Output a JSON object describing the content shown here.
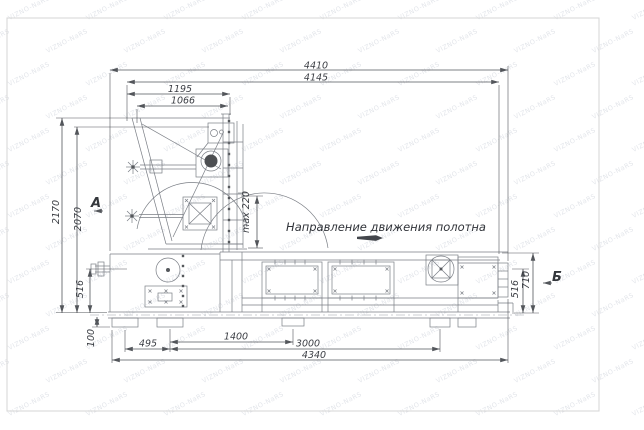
{
  "drawing": {
    "direction_note": "Направление движения полотна",
    "view_label_a": "А",
    "view_label_b": "Б",
    "dims": {
      "top_overall": "4410",
      "top_second": "4145",
      "top_third": "1195",
      "top_fourth": "1066",
      "left_height_overall": "2170",
      "left_height_second": "2070",
      "left_shaft_height": "516",
      "left_base_height": "100",
      "bottom_first": "495",
      "bottom_second": "1400",
      "bottom_third": "3000",
      "bottom_overall": "4340",
      "right_height": "516",
      "right_height_overall": "710",
      "max_gap": "max 220"
    },
    "colors": {
      "dimension_lines": "#53565b",
      "machine_lines": "#7a7e85",
      "border": "#d5d5d5",
      "background": "#ffffff",
      "motor_fill": "#4d4f52"
    },
    "watermark": {
      "text": "VIZNO-NaRS",
      "color": "#9aa3b5",
      "opacity": 0.28,
      "rotation_deg": -27,
      "font_size": 6.5,
      "x_step": 78,
      "y_step": 33
    }
  }
}
